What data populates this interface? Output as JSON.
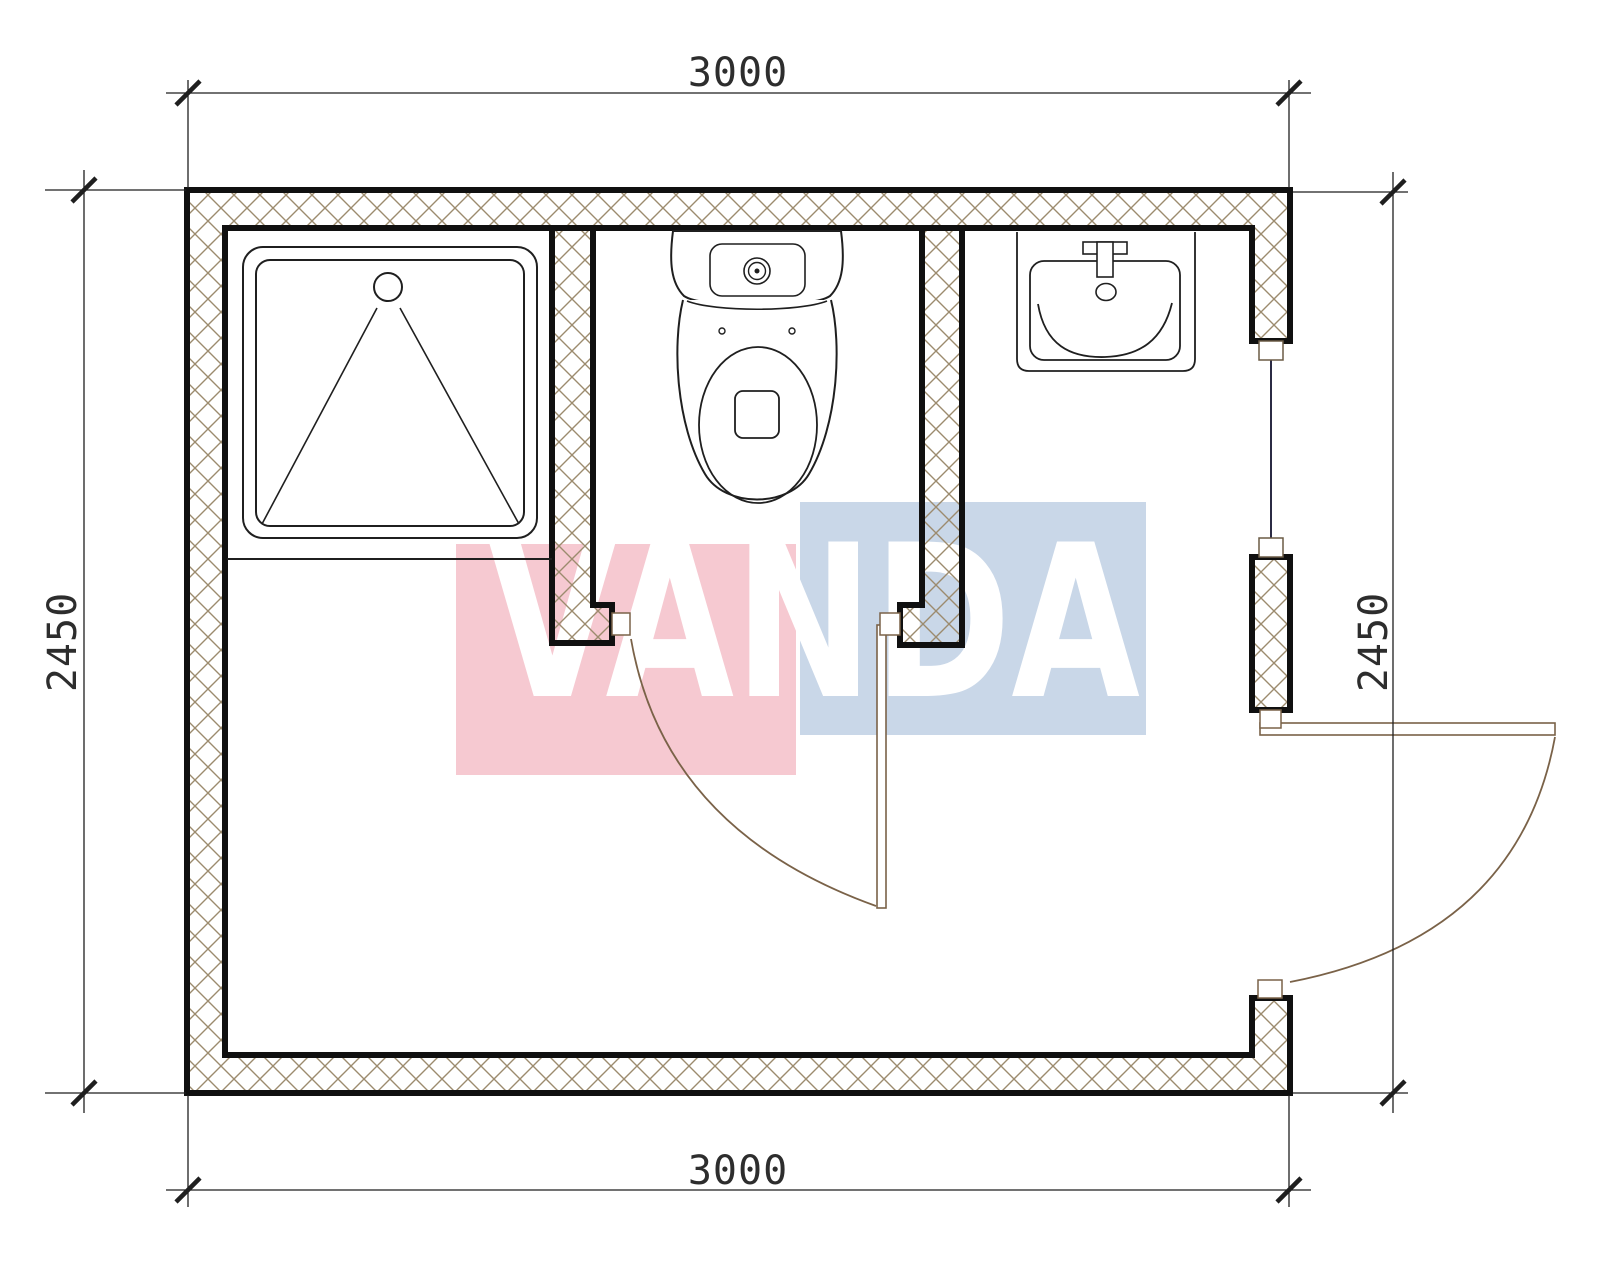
{
  "drawing": {
    "type": "bathroom-floor-plan",
    "dimensions": {
      "top": "3000",
      "bottom": "3000",
      "left": "2450",
      "right": "2450"
    },
    "fixtures": [
      "shower-tray",
      "toilet",
      "sink"
    ],
    "openings": [
      "window-right-wall",
      "entry-door-right-wall",
      "stall-door"
    ]
  },
  "watermark": {
    "text": "VANDA",
    "pink_color": "#f6c9d1",
    "blue_color": "#c9d7e8",
    "letter_color": "#ffffff"
  },
  "colors": {
    "wall_line": "#101010",
    "hatch_line": "#9c8b6e",
    "door_line": "#7a6248",
    "window_line": "#2b2b44",
    "dimension_line": "#1f1f1f",
    "fixture_line": "#1f1f1f"
  }
}
